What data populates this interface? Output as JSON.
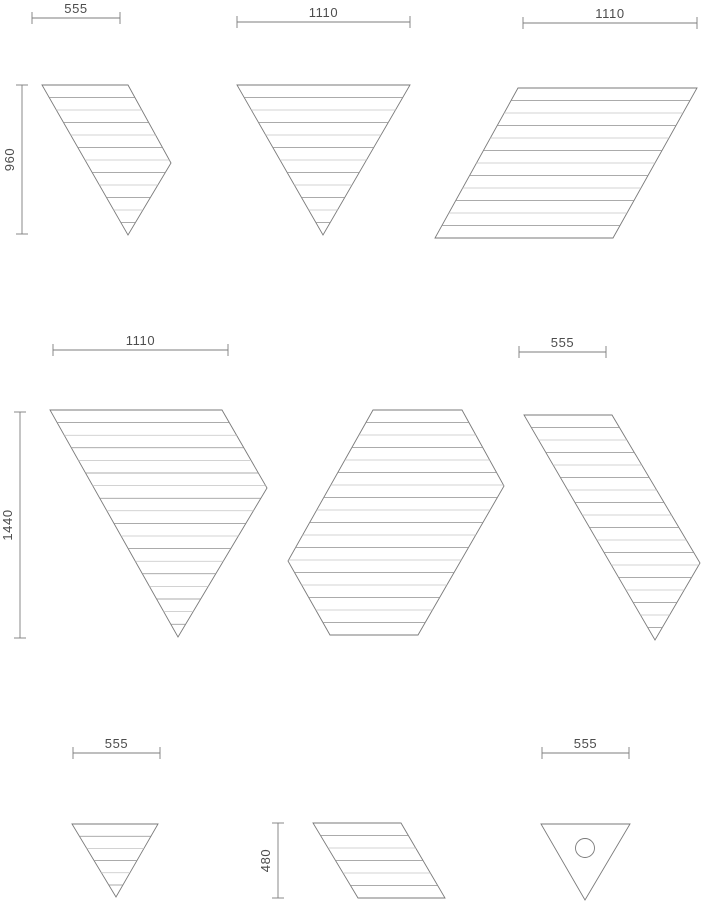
{
  "document": {
    "background": "#ffffff",
    "canvas_width": 706,
    "canvas_height": 905
  },
  "style": {
    "outline_color": "#7a7a7a",
    "hatch_color_dark": "#8f8f8f",
    "hatch_color_light": "#c4c4c4",
    "dim_line_color": "#7d7d7d",
    "dim_text_color": "#4d4d4d",
    "panel_fill": "#ffffff"
  },
  "panels": [
    {
      "id": "panel-top-left-rhomboid-triangle",
      "shape": "skewed-triangle",
      "points": [
        [
          42,
          85
        ],
        [
          128,
          85
        ],
        [
          171,
          163
        ],
        [
          128,
          235
        ]
      ],
      "hatch_spacing": 12.5
    },
    {
      "id": "panel-top-center-triangle",
      "shape": "triangle-down",
      "points": [
        [
          237,
          85
        ],
        [
          410,
          85
        ],
        [
          323,
          235
        ]
      ],
      "hatch_spacing": 12.5
    },
    {
      "id": "panel-top-right-parallelogram",
      "shape": "parallelogram-left",
      "points": [
        [
          518,
          88
        ],
        [
          697,
          88
        ],
        [
          613,
          238
        ],
        [
          435,
          238
        ]
      ],
      "hatch_spacing": 12.5
    },
    {
      "id": "panel-mid-left-rhomboid-triangle",
      "shape": "skewed-triangle",
      "points": [
        [
          50,
          410
        ],
        [
          222,
          410
        ],
        [
          267,
          488
        ],
        [
          178,
          637
        ]
      ],
      "hatch_spacing": 12.6
    },
    {
      "id": "panel-mid-center-hexagon",
      "shape": "skewed-hexagon",
      "points": [
        [
          373,
          410
        ],
        [
          462,
          410
        ],
        [
          504,
          486
        ],
        [
          418,
          635
        ],
        [
          330,
          635
        ],
        [
          288,
          561
        ]
      ],
      "hatch_spacing": 12.5
    },
    {
      "id": "panel-mid-right-rhomboid-triangle",
      "shape": "skewed-triangle",
      "points": [
        [
          524,
          415
        ],
        [
          612,
          415
        ],
        [
          700,
          563
        ],
        [
          655,
          640
        ]
      ],
      "hatch_spacing": 12.5
    },
    {
      "id": "panel-bottom-left-triangle",
      "shape": "triangle-down",
      "points": [
        [
          72,
          824
        ],
        [
          158,
          824
        ],
        [
          116,
          897
        ]
      ],
      "hatch_spacing": 12.2
    },
    {
      "id": "panel-bottom-center-parallelogram",
      "shape": "parallelogram-right",
      "points": [
        [
          313,
          823
        ],
        [
          401,
          823
        ],
        [
          445,
          898
        ],
        [
          358,
          898
        ]
      ],
      "hatch_spacing": 12.5
    },
    {
      "id": "panel-bottom-right-triangle-with-hole",
      "shape": "triangle-down-hole",
      "points": [
        [
          541,
          824
        ],
        [
          630,
          824
        ],
        [
          585,
          900
        ]
      ],
      "hatch_spacing": 0,
      "hole": {
        "cx": 585,
        "cy": 848,
        "r": 9.5
      }
    }
  ],
  "dimensions": [
    {
      "id": "dim-top-left-width",
      "orientation": "horizontal",
      "label": "555",
      "x1": 32,
      "x2": 120,
      "y": 18
    },
    {
      "id": "dim-top-center-width",
      "orientation": "horizontal",
      "label": "1110",
      "x1": 237,
      "x2": 410,
      "y": 22
    },
    {
      "id": "dim-top-right-width",
      "orientation": "horizontal",
      "label": "1110",
      "x1": 523,
      "x2": 697,
      "y": 23
    },
    {
      "id": "dim-top-left-height",
      "orientation": "vertical",
      "label": "960",
      "x": 22,
      "y1": 85,
      "y2": 234
    },
    {
      "id": "dim-mid-left-width",
      "orientation": "horizontal",
      "label": "1110",
      "x1": 53,
      "x2": 228,
      "y": 350
    },
    {
      "id": "dim-mid-right-width",
      "orientation": "horizontal",
      "label": "555",
      "x1": 519,
      "x2": 606,
      "y": 352
    },
    {
      "id": "dim-mid-left-height",
      "orientation": "vertical",
      "label": "1440",
      "x": 20,
      "y1": 412,
      "y2": 638
    },
    {
      "id": "dim-bottom-left-width",
      "orientation": "horizontal",
      "label": "555",
      "x1": 73,
      "x2": 160,
      "y": 753
    },
    {
      "id": "dim-bottom-center-height",
      "orientation": "vertical",
      "label": "480",
      "x": 278,
      "y1": 823,
      "y2": 898
    },
    {
      "id": "dim-bottom-right-width",
      "orientation": "horizontal",
      "label": "555",
      "x1": 542,
      "x2": 629,
      "y": 753
    }
  ]
}
